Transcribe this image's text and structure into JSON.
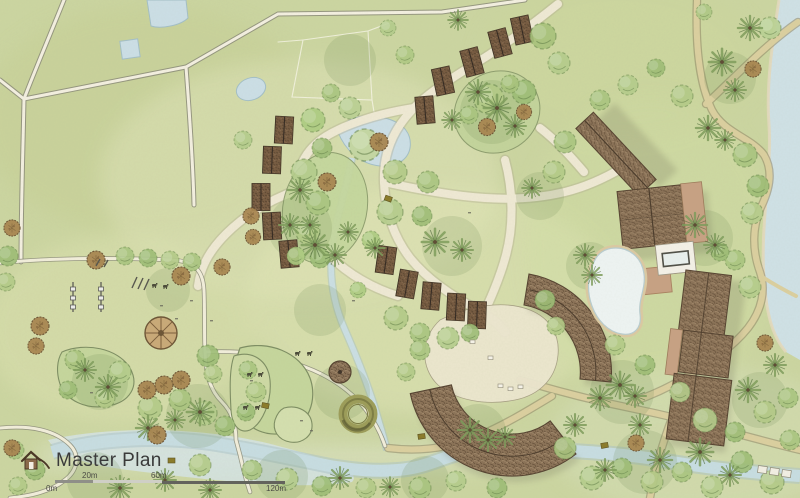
{
  "title": {
    "text": "Master Plan",
    "icon": "hut-logo-icon",
    "color": "#3a3a3a"
  },
  "scale_bar": {
    "labels": [
      "0m",
      "20m",
      "60m",
      "120m"
    ]
  },
  "palette": {
    "field_green": "#ccd6a1",
    "path_cream": "#f1ecd9",
    "road_tan": "#d9cd9e",
    "water": "#c6dce2",
    "pool_white": "#edf3f2",
    "thatch_roof": "#856c50",
    "cabin_roof": "#75593f",
    "flat_roof_tan": "#c7a183",
    "canopy_green": "#a9c47e",
    "palm_green": "#7d9c5a",
    "orchard_brown": "#a8854f",
    "scalebar_dark": "#63635c",
    "scalebar_light": "#cfcfc6",
    "title_text": "#3a3a3a"
  }
}
